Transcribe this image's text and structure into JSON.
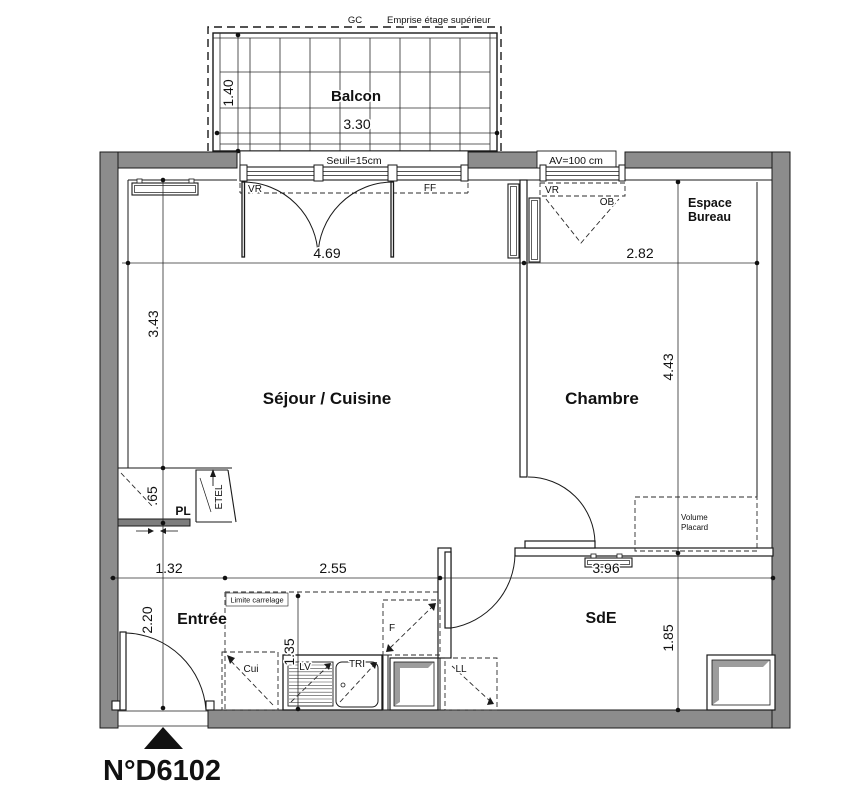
{
  "title": "N°D6102",
  "balcony": {
    "gc": "GC",
    "emprise": "Emprise étage supérieur",
    "name": "Balcon",
    "width": "3.30",
    "depth": "1.40",
    "seuil": "Seuil=15cm"
  },
  "openings": {
    "vr_sejour": "VR",
    "ff": "FF",
    "vr_chambre": "VR",
    "ob": "OB",
    "av": "AV=100 cm"
  },
  "rooms": {
    "sejour": "Séjour / Cuisine",
    "chambre": "Chambre",
    "entree": "Entrée",
    "sde": "SdE",
    "bureau_line1": "Espace",
    "bureau_line2": "Bureau",
    "placard_line1": "Volume",
    "placard_line2": "Placard"
  },
  "closets": {
    "pl": "PL",
    "etel": "ETEL"
  },
  "kitchen": {
    "cui": "Cui",
    "lv": "LV",
    "tri": "TRI",
    "f": "F",
    "ll": "LL",
    "limite": "Limite carrelage"
  },
  "dims": {
    "sejour_w": "4.69",
    "chambre_w": "2.82",
    "sejour_h": "3.43",
    "chambre_h": "4.43",
    "entree_w": "1.32",
    "kitchen_w": "2.55",
    "sde_w": "3.96",
    "entree_h": "2.20",
    "sde_h": "1.85",
    "pl_d": ".65",
    "kitchen_d": "1.35"
  },
  "colors": {
    "wall": "#8c8c8c",
    "line": "#1a1a1a",
    "shade": "#9d9d9d"
  }
}
